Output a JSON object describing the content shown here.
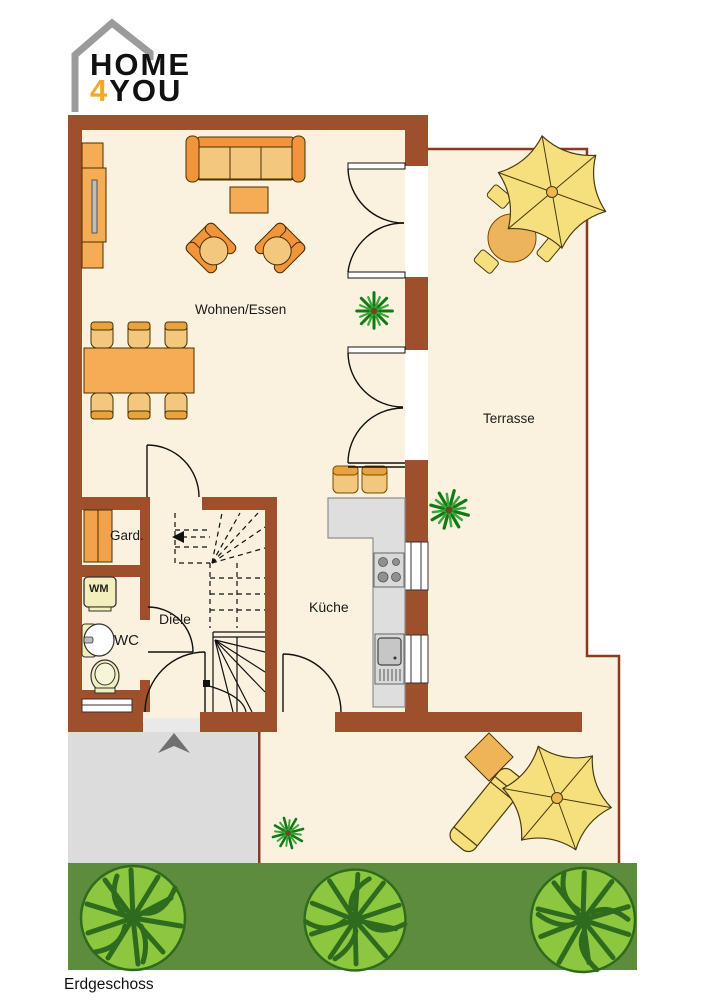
{
  "logo": {
    "word1": "HOME",
    "digit": "4",
    "word2": "YOU"
  },
  "plan": {
    "rooms": [
      {
        "id": "wohnen-essen",
        "label": "Wohnen/Essen"
      },
      {
        "id": "terrasse",
        "label": "Terrasse"
      },
      {
        "id": "garderobe",
        "label": "Gard."
      },
      {
        "id": "diele",
        "label": "Diele"
      },
      {
        "id": "wc",
        "label": "WC"
      },
      {
        "id": "kueche",
        "label": "Küche"
      }
    ],
    "appliances": {
      "wm": "WM"
    },
    "floor_label": "Erdgeschoss",
    "colors": {
      "wall": "#9E4F2B",
      "floor": "#FAF2DE",
      "terrace_border": "#8B3A20",
      "furniture_orange": "#F5AC55",
      "furniture_dark_orange": "#F0953C",
      "furniture_light": "#F3C77E",
      "logo_accent": "#F5A623",
      "parasol_yellow": "#F6E07E",
      "counter_gray": "#DEDEDE",
      "porch_gray": "#DCDCDC",
      "grass_green": "#5C8C3C",
      "bush_green": "#8DC63F"
    }
  }
}
